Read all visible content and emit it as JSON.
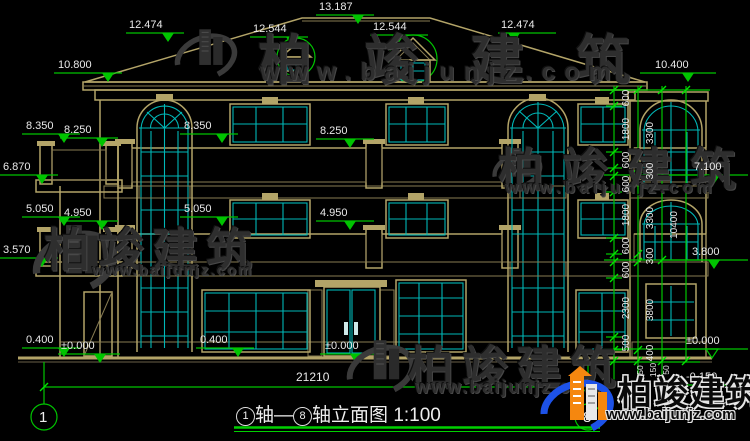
{
  "drawing": {
    "title": {
      "axis_start": "1",
      "axis_sep": "轴—",
      "axis_end": "8",
      "name": "轴立面图",
      "scale": "1:100"
    },
    "axis_bubbles": {
      "left": "1",
      "right": "8"
    },
    "bottom_dim": "21210",
    "levels_top": [
      "12.474",
      "12.544",
      "13.187",
      "12.544",
      "12.474"
    ],
    "levels_left": [
      "10.800",
      "8.350",
      "8.250",
      "6.870",
      "5.050",
      "4.950",
      "3.570",
      "0.400",
      "±0.000"
    ],
    "levels_mid": [
      "8.350",
      "8.250",
      "5.050",
      "4.950",
      "0.400",
      "±0.000"
    ],
    "levels_right": [
      "10.400",
      "7.100",
      "3.800",
      "±0.000",
      "-0.150"
    ],
    "right_dims_col1": [
      "600",
      "1800",
      "600",
      "600",
      "1800",
      "600",
      "600",
      "2300",
      "500"
    ],
    "right_dims_col2": [
      "3300",
      "300",
      "3300",
      "300",
      "3800",
      "400"
    ],
    "right_dims_col3": [
      "10400"
    ],
    "right_dims_small": [
      "50",
      "150",
      "50"
    ]
  },
  "watermark": {
    "brand": "柏竣建筑",
    "url": "www.baijunjz.com"
  },
  "colors": {
    "line_tan": "#b3a468",
    "window_cyan": "#00b7b7",
    "dim_green": "#00c400",
    "rail_blue": "#4356d6",
    "logo_blue": "#1d52e8",
    "logo_orange": "#f5870f"
  }
}
